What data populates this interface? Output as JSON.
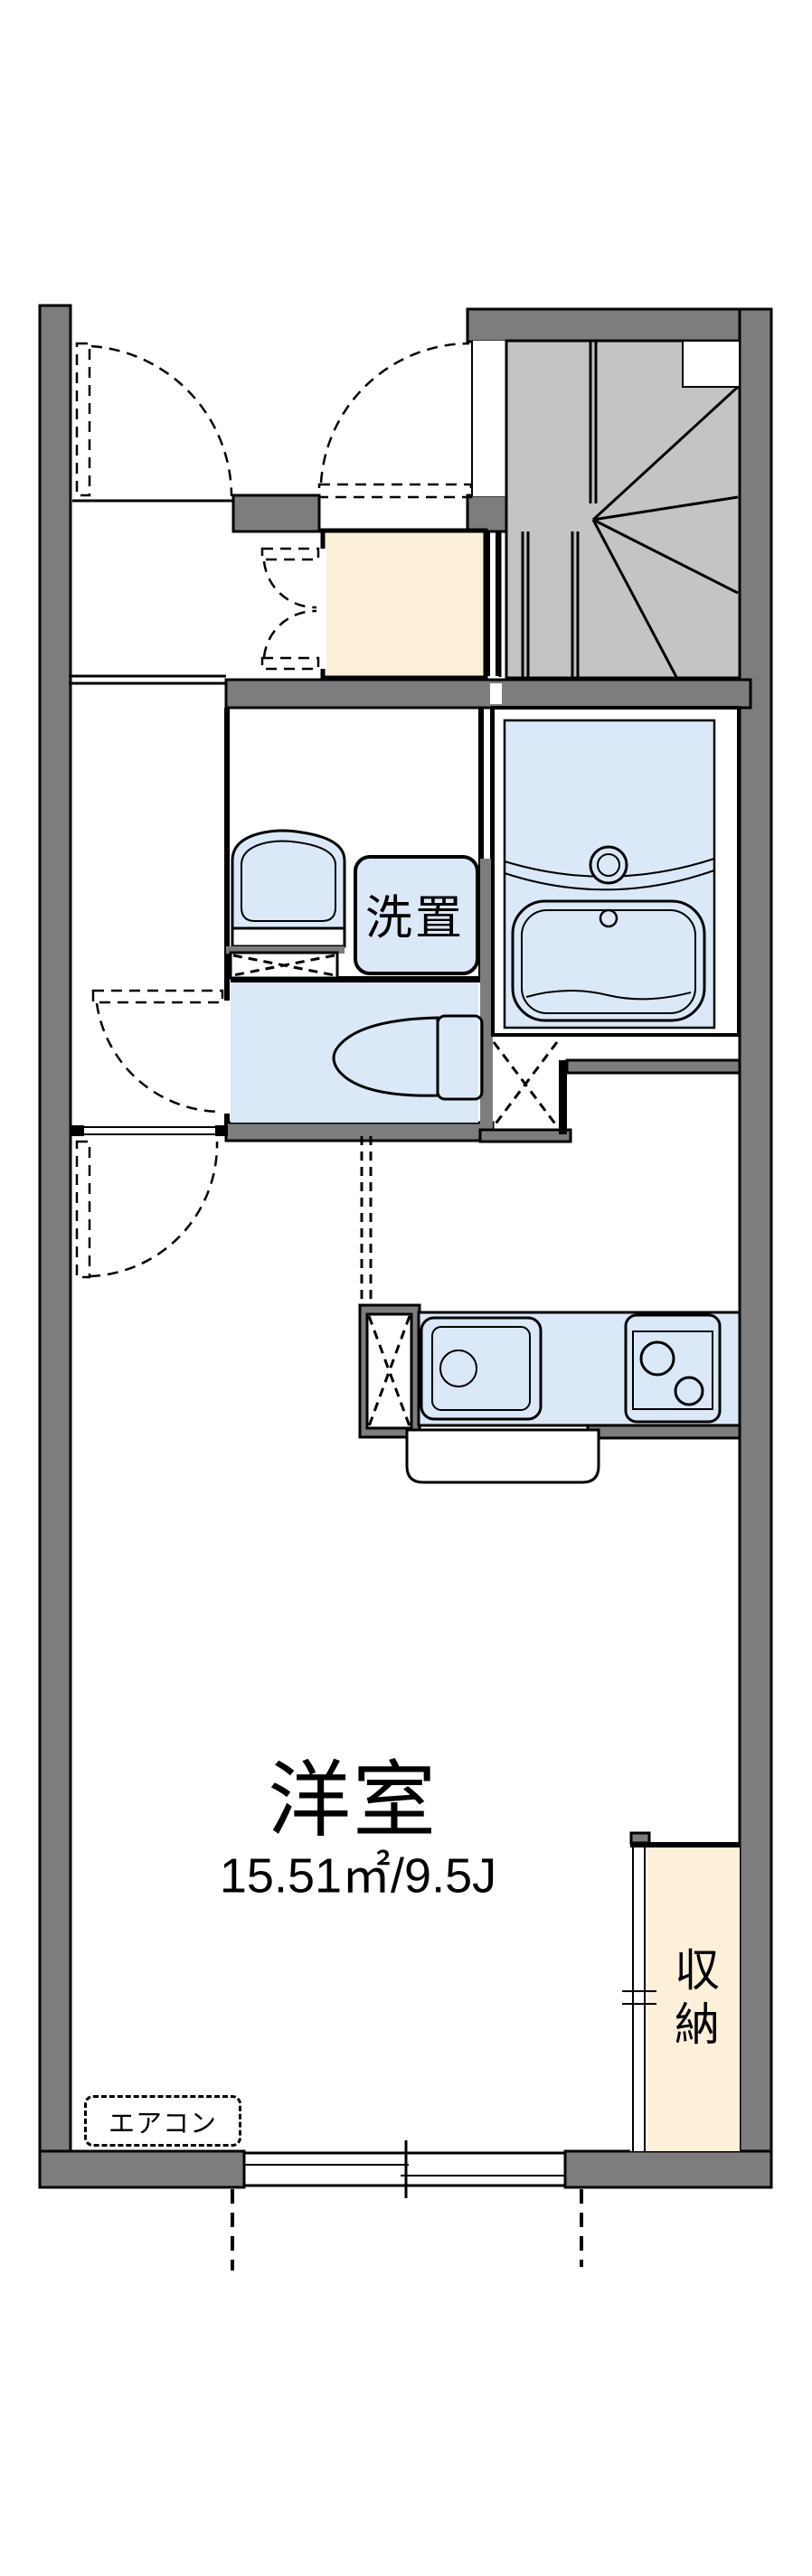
{
  "colors": {
    "wall": "#7d7d7d",
    "stair": "#c4c4c4",
    "wet": "#dbe8f8",
    "beige": "#fcf0d9",
    "line": "#000000",
    "paper": "#ffffff"
  },
  "labels": {
    "washer": "洗置",
    "main_room": "洋室",
    "main_room_area": "15.51㎡/9.5J",
    "closet": "収納",
    "aircon": "エアコン"
  }
}
